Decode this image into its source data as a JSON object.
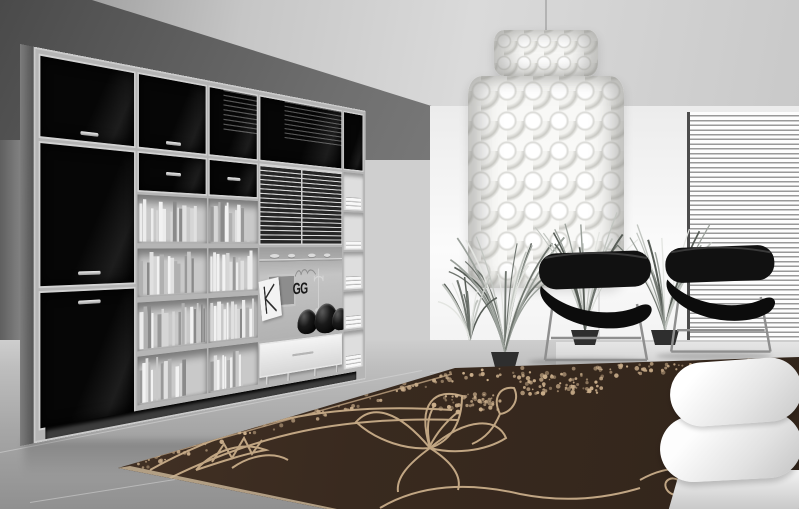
{
  "scene": {
    "type": "interior-photograph",
    "description": "Black-and-white modern living room: dark glossy wall-unit bookcase full of books at left, capiz-shell chandelier, two black designer lounge chairs before horizontal window blinds, potted ornamental grasses, white sofa corner at right, and a chocolate-brown area rug with cream floral line-art filling the foreground",
    "width_px": 799,
    "height_px": 509
  },
  "palette": {
    "ceiling": "#cfcfcf",
    "wall_shadow": "#565656",
    "wall_white": "#f6f6f6",
    "cabinet_black": "#0b0b0b",
    "frame_silver": "#c6c6c6",
    "floor_gray": "#a8a8a8",
    "chair_black": "#141414",
    "chrome": "#9a9a9a",
    "sofa_white": "#f1f1f1",
    "rug_brown": "#3a2b20",
    "rug_pattern_cream": "#c9ad8a",
    "plant_gray": "#9aa09a",
    "chandelier_white": "#f6f6f3"
  },
  "watermark": {
    "logo_text": "GG"
  },
  "wall_unit": {
    "glass_door_cells": 5,
    "tall_black_doors": 2,
    "book_cells": 8,
    "books_min": 11,
    "books_max": 16,
    "spine_palette": [
      "#f2f2f2",
      "#e0e0e0",
      "#c8c8c8",
      "#b0b0b0",
      "#989898",
      "#d6d6d6",
      "#8a8a8a",
      "#ececec"
    ],
    "linen_cells": 5,
    "dish_count": 4,
    "bowl_count": 3
  },
  "rug": {
    "speckle_count": 150,
    "clusters": [
      {
        "x": 560,
        "y": 34,
        "w": 86,
        "h": 20,
        "n": 70
      },
      {
        "x": 470,
        "y": 52,
        "w": 60,
        "h": 16,
        "n": 45
      },
      {
        "x": 745,
        "y": 24,
        "w": 100,
        "h": 18,
        "n": 60
      }
    ]
  },
  "plants": [
    {
      "x": 505,
      "y": 352,
      "height": 132,
      "spread": 60,
      "blades": 26,
      "pot": true
    },
    {
      "x": 585,
      "y": 330,
      "height": 120,
      "spread": 54,
      "blades": 22,
      "pot": true
    },
    {
      "x": 665,
      "y": 330,
      "height": 106,
      "spread": 48,
      "blades": 20,
      "pot": true
    },
    {
      "x": 470,
      "y": 340,
      "height": 66,
      "spread": 34,
      "blades": 12,
      "pot": false
    }
  ]
}
